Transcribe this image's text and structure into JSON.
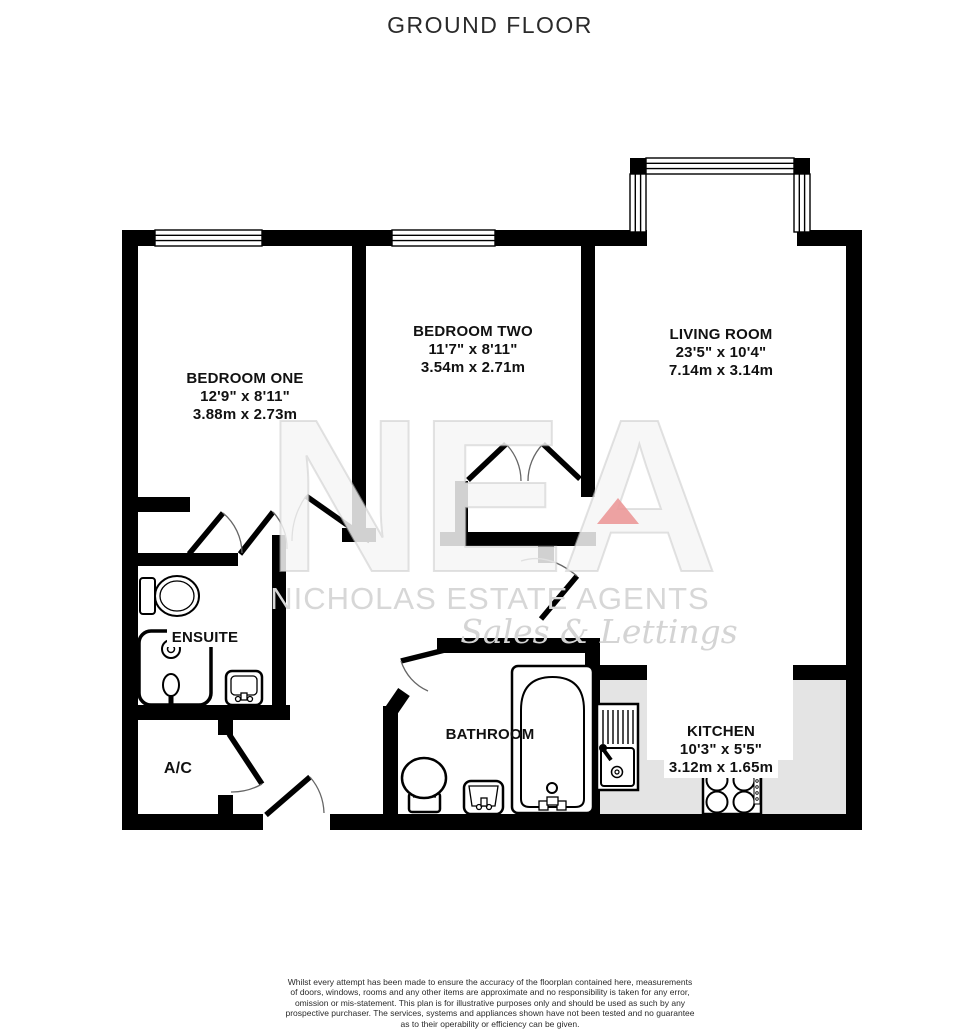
{
  "title": "GROUND FLOOR",
  "rooms": {
    "bedroom_one": {
      "name": "BEDROOM ONE",
      "dims_ft": "12'9\"  x 8'11\"",
      "dims_m": "3.88m  x 2.73m"
    },
    "bedroom_two": {
      "name": "BEDROOM TWO",
      "dims_ft": "11'7\"  x 8'11\"",
      "dims_m": "3.54m  x 2.71m"
    },
    "living_room": {
      "name": "LIVING ROOM",
      "dims_ft": "23'5\"  x 10'4\"",
      "dims_m": "7.14m  x 3.14m"
    },
    "kitchen": {
      "name": "KITCHEN",
      "dims_ft": "10'3\"  x 5'5\"",
      "dims_m": "3.12m  x 1.65m"
    },
    "bathroom": {
      "name": "BATHROOM"
    },
    "ensuite": {
      "name": "ENSUITE"
    },
    "ac": {
      "name": "A/C"
    }
  },
  "watermark": {
    "monogram": "NEA",
    "agency": "NICHOLAS ESTATE AGENTS",
    "tagline": "Sales & Lettings",
    "triangle_color": "#eb9898"
  },
  "colors": {
    "wall": "#000000",
    "counter_gray": "#e4e4e4",
    "watermark_gray": "#d7d7d7"
  },
  "footer": {
    "lines": [
      "Whilst every attempt has been made to ensure the accuracy of the floorplan contained here, measurements",
      "of doors, windows, rooms and any other items are approximate and no responsibility is taken for any error,",
      "omission or mis-statement. This plan is for illustrative purposes only and should be used as such by any",
      "prospective purchaser. The services, systems and appliances shown have not been tested and no guarantee",
      "as to their operability or efficiency can be given."
    ],
    "credit": "Made with Metropix ©2022"
  }
}
